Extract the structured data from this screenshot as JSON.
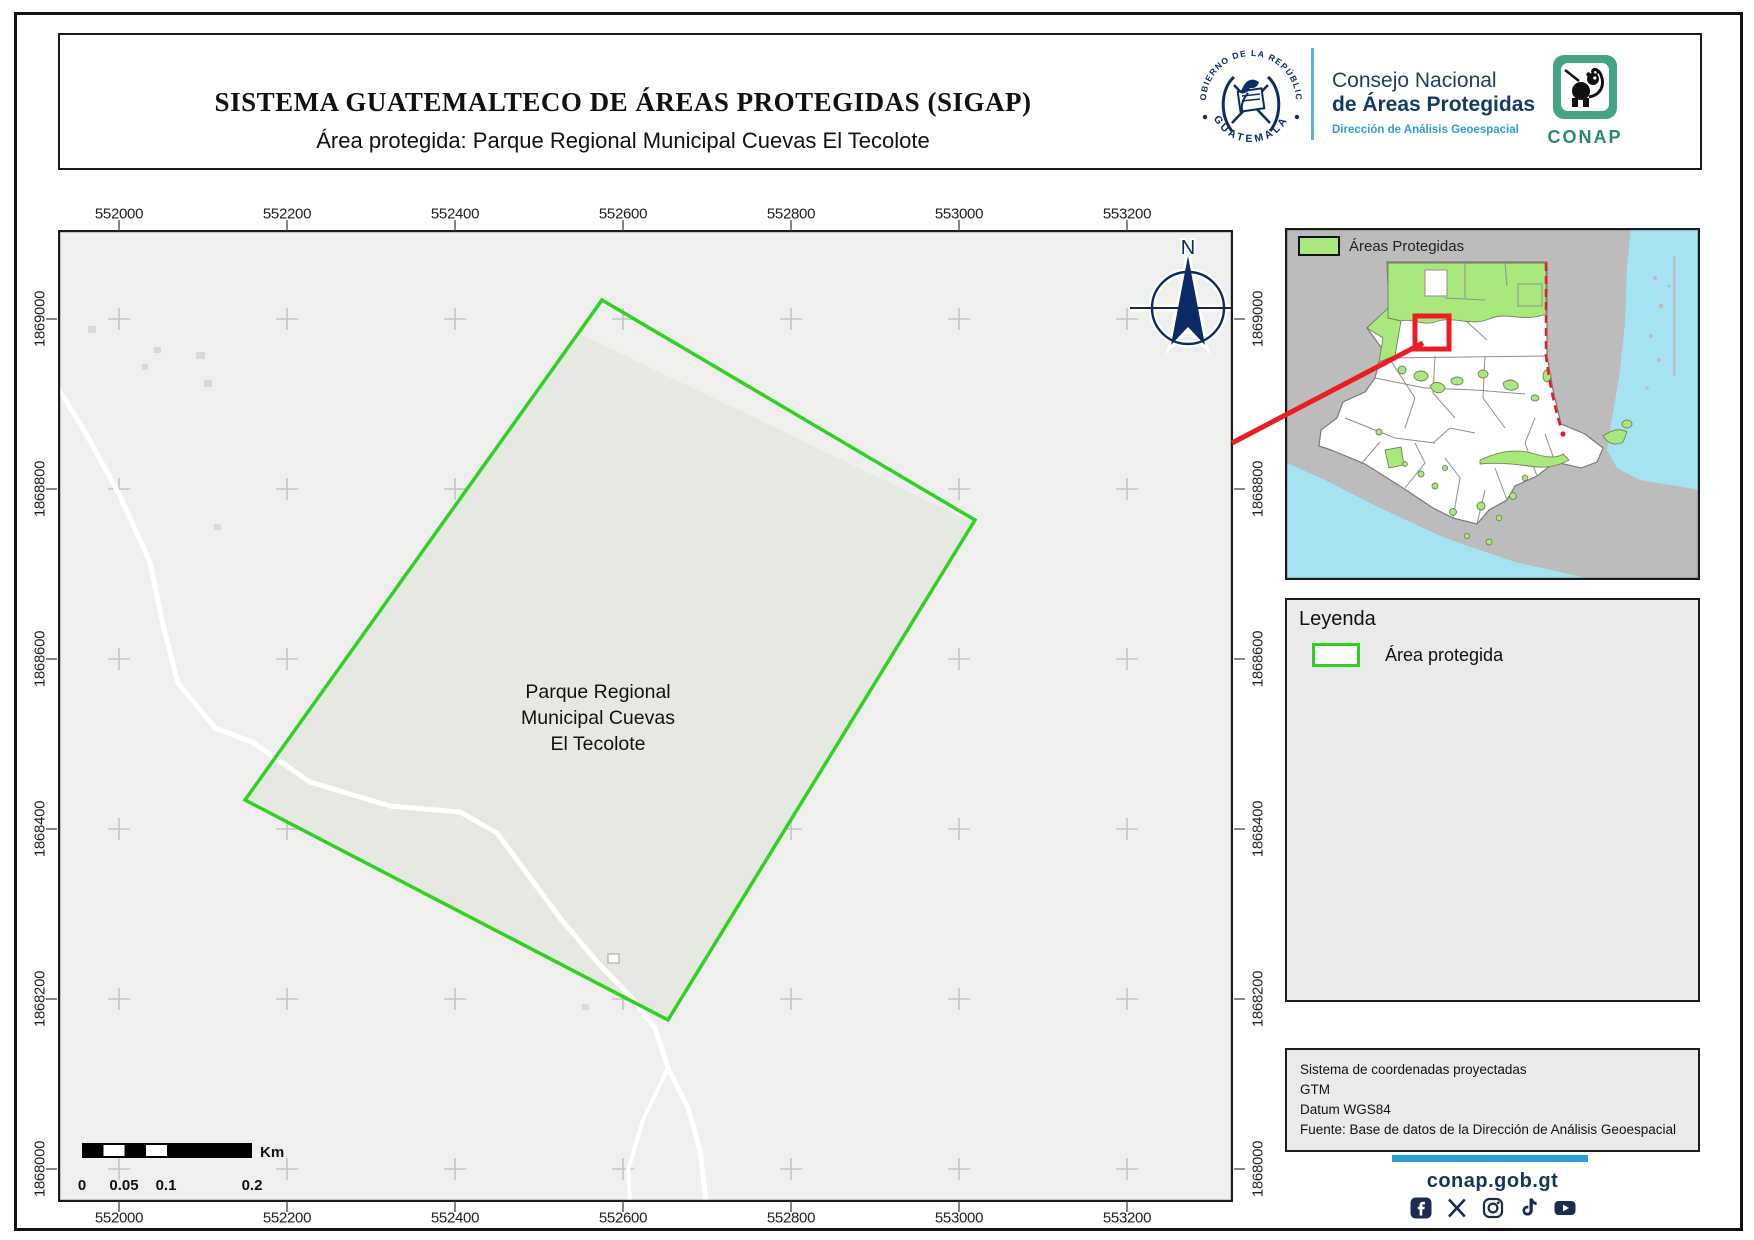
{
  "header": {
    "title": "SISTEMA GUATEMALTECO DE ÁREAS PROTEGIDAS  (SIGAP)",
    "subtitle": "Área protegida: Parque Regional Municipal Cuevas El Tecolote",
    "seal_text_top": "GOBIERNO DE LA REPÚBLICA",
    "seal_text_bottom": "GUATEMALA",
    "org_name_line1": "Consejo Nacional",
    "org_name_line2": "de Áreas Protegidas",
    "org_department": "Dirección de Análisis Geoespacial",
    "conap_wordmark": "CONAP"
  },
  "map": {
    "x_ticks": [
      "552000",
      "552200",
      "552400",
      "552600",
      "552800",
      "553000",
      "553200"
    ],
    "y_ticks": [
      "1869000",
      "1868800",
      "1868600",
      "1868400",
      "1868200",
      "1868000"
    ],
    "area_label_lines": [
      "Parque Regional",
      "Municipal Cuevas",
      "El Tecolote"
    ],
    "north_label": "N",
    "scalebar": {
      "ticks": [
        "0",
        "0.05",
        "0.1",
        "0.2"
      ],
      "unit": "Km"
    }
  },
  "inset": {
    "legend_label": "Áreas Protegidas"
  },
  "legend_box": {
    "title": "Leyenda",
    "item_label": "Área protegida"
  },
  "info_box": {
    "lines": [
      "Sistema de coordenadas proyectadas",
      "GTM",
      "Datum WGS84",
      "Fuente: Base de datos de la Dirección de Análisis Geoespacial"
    ]
  },
  "footer": {
    "website": "conap.gob.gt",
    "social_icons": [
      "facebook",
      "x",
      "instagram",
      "tiktok",
      "youtube"
    ]
  },
  "colors": {
    "protected_outline_green": "#2ed321",
    "inset_protected_green": "#a8e87c",
    "water_cyan": "#a5e3f3",
    "locator_red": "#ed1c24",
    "brand_navy": "#16355e",
    "brand_light_blue": "#2e9fd4",
    "conap_green": "#47a480"
  }
}
